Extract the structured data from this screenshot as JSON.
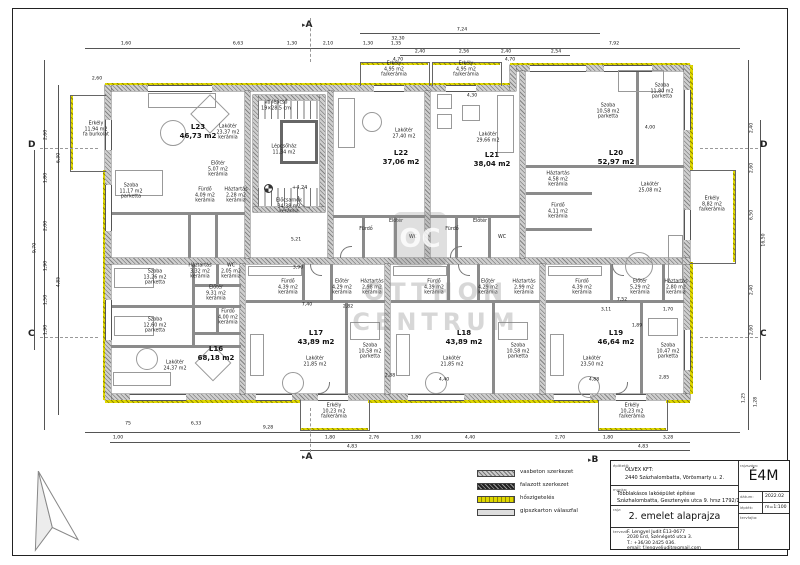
{
  "markers": {
    "a": "A",
    "b": "B",
    "c": "C",
    "d": "D"
  },
  "icons": {
    "section_arrow": "▸"
  },
  "level_mark": "+4,24",
  "watermark": {
    "logo": "OC",
    "line1": "OTTHON",
    "line2": "CENTRUM"
  },
  "legend": {
    "items": [
      {
        "label": "vasbeton szerkezet"
      },
      {
        "label": "falazott szerkezet"
      },
      {
        "label": "hőszigetelés"
      },
      {
        "label": "gipszkarton válaszfal"
      }
    ]
  },
  "apartments": {
    "l23": {
      "id": "L23",
      "area": "46,73 m2"
    },
    "l22": {
      "id": "L22",
      "area": "37,06 m2"
    },
    "l21": {
      "id": "L21",
      "area": "38,04 m2"
    },
    "l20": {
      "id": "L20",
      "area": "52,97 m2"
    },
    "l16": {
      "id": "L16",
      "area": "68,18 m2"
    },
    "l17": {
      "id": "L17",
      "area": "43,89 m2"
    },
    "l18": {
      "id": "L18",
      "area": "43,89 m2"
    },
    "l19": {
      "id": "L19",
      "area": "46,64 m2"
    }
  },
  "room_labels": [
    {
      "x": 96,
      "y": 130,
      "l": [
        "Erkély",
        "11,94 m2",
        "fa burkolat"
      ]
    },
    {
      "x": 228,
      "y": 133,
      "l": [
        "Lakótér",
        "23,37 m2",
        "kerámia"
      ]
    },
    {
      "x": 131,
      "y": 192,
      "l": [
        "Szoba",
        "11,17 m2",
        "parketta"
      ]
    },
    {
      "x": 218,
      "y": 170,
      "l": [
        "Előtér",
        "5,07 m2",
        "kerámia"
      ]
    },
    {
      "x": 205,
      "y": 196,
      "l": [
        "Fürdő",
        "4,09 m2",
        "kerámia"
      ]
    },
    {
      "x": 236,
      "y": 196,
      "l": [
        "Háztartás",
        "2,28 m2",
        "kerámia"
      ]
    },
    {
      "x": 284,
      "y": 150,
      "l": [
        "Lépcsőház",
        "11,34 m2"
      ]
    },
    {
      "x": 276,
      "y": 106,
      "l": [
        "vb lépcső",
        "19×28,5 cm"
      ]
    },
    {
      "x": 289,
      "y": 207,
      "l": [
        "Előcsarnok",
        "34,38 m2",
        "kerámia"
      ]
    },
    {
      "x": 404,
      "y": 134,
      "l": [
        "Lakótér",
        "27,40 m2"
      ]
    },
    {
      "x": 394,
      "y": 70,
      "l": [
        "Erkély",
        "4,95 m2",
        "fa/kerámia"
      ]
    },
    {
      "x": 466,
      "y": 70,
      "l": [
        "Erkély",
        "4,95 m2",
        "fa/kerámia"
      ]
    },
    {
      "x": 366,
      "y": 230,
      "l": [
        "Fürdő"
      ]
    },
    {
      "x": 396,
      "y": 222,
      "l": [
        "Előtér"
      ]
    },
    {
      "x": 413,
      "y": 238,
      "l": [
        "WC"
      ]
    },
    {
      "x": 488,
      "y": 138,
      "l": [
        "Lakótér",
        "29,66 m2"
      ]
    },
    {
      "x": 452,
      "y": 230,
      "l": [
        "Fürdő"
      ]
    },
    {
      "x": 480,
      "y": 222,
      "l": [
        "Előtér"
      ]
    },
    {
      "x": 502,
      "y": 238,
      "l": [
        "WC"
      ]
    },
    {
      "x": 608,
      "y": 112,
      "l": [
        "Szoba",
        "10,58 m2",
        "parketta"
      ]
    },
    {
      "x": 662,
      "y": 92,
      "l": [
        "Szoba",
        "11,80 m2",
        "parketta"
      ]
    },
    {
      "x": 650,
      "y": 188,
      "l": [
        "Lakótér",
        "25,08 m2"
      ]
    },
    {
      "x": 558,
      "y": 180,
      "l": [
        "Háztartás",
        "4,58 m2",
        "kerámia"
      ]
    },
    {
      "x": 558,
      "y": 212,
      "l": [
        "Fürdő",
        "4,11 m2",
        "kerámia"
      ]
    },
    {
      "x": 712,
      "y": 205,
      "l": [
        "Erkély",
        "8,82 m2",
        "fa/kerámia"
      ]
    },
    {
      "x": 155,
      "y": 278,
      "l": [
        "Szoba",
        "13,26 m2",
        "parketta"
      ]
    },
    {
      "x": 155,
      "y": 326,
      "l": [
        "Szoba",
        "12,60 m2",
        "parketta"
      ]
    },
    {
      "x": 216,
      "y": 294,
      "l": [
        "Előtér",
        "9,31 m2",
        "kerámia"
      ]
    },
    {
      "x": 228,
      "y": 318,
      "l": [
        "Fürdő",
        "4,00 m2",
        "kerámia"
      ]
    },
    {
      "x": 231,
      "y": 272,
      "l": [
        "WC",
        "2,05 m2",
        "kerámia"
      ]
    },
    {
      "x": 200,
      "y": 272,
      "l": [
        "Háztartás",
        "3,32 m2",
        "kerámia"
      ]
    },
    {
      "x": 175,
      "y": 366,
      "l": [
        "Lakótér",
        "24,37 m2"
      ]
    },
    {
      "x": 288,
      "y": 288,
      "l": [
        "Fürdő",
        "4,39 m2",
        "kerámia"
      ]
    },
    {
      "x": 342,
      "y": 288,
      "l": [
        "Előtér",
        "4,29 m2",
        "kerámia"
      ]
    },
    {
      "x": 372,
      "y": 288,
      "l": [
        "Háztartás",
        "2,98 m2",
        "kerámia"
      ]
    },
    {
      "x": 315,
      "y": 362,
      "l": [
        "Lakótér",
        "21,85 m2"
      ]
    },
    {
      "x": 370,
      "y": 352,
      "l": [
        "Szoba",
        "10,58 m2",
        "parketta"
      ]
    },
    {
      "x": 334,
      "y": 412,
      "l": [
        "Erkély",
        "10,23 m2",
        "fa/kerámia"
      ]
    },
    {
      "x": 434,
      "y": 288,
      "l": [
        "Fürdő",
        "4,39 m2",
        "kerámia"
      ]
    },
    {
      "x": 488,
      "y": 288,
      "l": [
        "Előtér",
        "4,29 m2",
        "kerámia"
      ]
    },
    {
      "x": 524,
      "y": 288,
      "l": [
        "Háztartás",
        "2,99 m2",
        "kerámia"
      ]
    },
    {
      "x": 452,
      "y": 362,
      "l": [
        "Lakótér",
        "21,85 m2"
      ]
    },
    {
      "x": 518,
      "y": 352,
      "l": [
        "Szoba",
        "10,58 m2",
        "parketta"
      ]
    },
    {
      "x": 582,
      "y": 288,
      "l": [
        "Fürdő",
        "4,39 m2",
        "kerámia"
      ]
    },
    {
      "x": 640,
      "y": 288,
      "l": [
        "Előtér",
        "5,29 m2",
        "kerámia"
      ]
    },
    {
      "x": 676,
      "y": 288,
      "l": [
        "Háztartás",
        "2,80 m2",
        "kerámia"
      ]
    },
    {
      "x": 592,
      "y": 362,
      "l": [
        "Lakótér",
        "23,50 m2"
      ]
    },
    {
      "x": 668,
      "y": 352,
      "l": [
        "Szoba",
        "10,47 m2",
        "parketta"
      ]
    },
    {
      "x": 632,
      "y": 412,
      "l": [
        "Erkély",
        "10,23 m2",
        "fa/kerámia"
      ]
    }
  ],
  "dim_labels": [
    {
      "t": "1,60",
      "x": 126,
      "y": 44
    },
    {
      "t": "6,63",
      "x": 238,
      "y": 44
    },
    {
      "t": "1,30",
      "x": 292,
      "y": 44
    },
    {
      "t": "2,10",
      "x": 328,
      "y": 44
    },
    {
      "t": "1,30",
      "x": 368,
      "y": 44
    },
    {
      "t": "1,35",
      "x": 396,
      "y": 44
    },
    {
      "t": "7,92",
      "x": 614,
      "y": 44
    },
    {
      "t": "2,40",
      "x": 420,
      "y": 52
    },
    {
      "t": "2,56",
      "x": 464,
      "y": 52
    },
    {
      "t": "2,40",
      "x": 506,
      "y": 52
    },
    {
      "t": "2,54",
      "x": 556,
      "y": 52
    },
    {
      "t": "7,24",
      "x": 462,
      "y": 30
    },
    {
      "t": "32,30",
      "x": 398,
      "y": 39
    },
    {
      "t": "4,70",
      "x": 398,
      "y": 60
    },
    {
      "t": "4,70",
      "x": 510,
      "y": 60
    },
    {
      "t": "4,30",
      "x": 472,
      "y": 96
    },
    {
      "t": "4,00",
      "x": 650,
      "y": 128
    },
    {
      "t": "2,60",
      "x": 97,
      "y": 79
    },
    {
      "t": "5,21",
      "x": 296,
      "y": 240
    },
    {
      "t": "3,90",
      "x": 298,
      "y": 268
    },
    {
      "t": "7,40",
      "x": 307,
      "y": 305
    },
    {
      "t": "2,82",
      "x": 348,
      "y": 307
    },
    {
      "t": "7,52",
      "x": 622,
      "y": 300
    },
    {
      "t": "3,11",
      "x": 606,
      "y": 310
    },
    {
      "t": "1,70",
      "x": 668,
      "y": 310
    },
    {
      "t": "1,89",
      "x": 637,
      "y": 326
    },
    {
      "t": "2,88",
      "x": 390,
      "y": 376
    },
    {
      "t": "4,40",
      "x": 444,
      "y": 380
    },
    {
      "t": "4,88",
      "x": 594,
      "y": 380
    },
    {
      "t": "2,85",
      "x": 664,
      "y": 378
    },
    {
      "t": "2,60",
      "x": 46,
      "y": 135,
      "v": 1
    },
    {
      "t": "1,80",
      "x": 46,
      "y": 178,
      "v": 1
    },
    {
      "t": "2,00",
      "x": 46,
      "y": 226,
      "v": 1
    },
    {
      "t": "1,90",
      "x": 46,
      "y": 266,
      "v": 1
    },
    {
      "t": "1,50",
      "x": 46,
      "y": 300,
      "v": 1
    },
    {
      "t": "1,90",
      "x": 46,
      "y": 330,
      "v": 1
    },
    {
      "t": "6,30",
      "x": 59,
      "y": 158,
      "v": 1
    },
    {
      "t": "4,85",
      "x": 59,
      "y": 282,
      "v": 1
    },
    {
      "t": "9,70",
      "x": 35,
      "y": 248,
      "v": 1
    },
    {
      "t": "2,40",
      "x": 752,
      "y": 128,
      "v": 1
    },
    {
      "t": "2,60",
      "x": 752,
      "y": 168,
      "v": 1
    },
    {
      "t": "6,50",
      "x": 752,
      "y": 215,
      "v": 1
    },
    {
      "t": "2,40",
      "x": 752,
      "y": 290,
      "v": 1
    },
    {
      "t": "2,60",
      "x": 752,
      "y": 330,
      "v": 1
    },
    {
      "t": "16,50",
      "x": 764,
      "y": 240,
      "v": 1
    },
    {
      "t": "1,25",
      "x": 744,
      "y": 398,
      "v": 1
    },
    {
      "t": "1,28",
      "x": 756,
      "y": 402,
      "v": 1
    },
    {
      "t": "75",
      "x": 128,
      "y": 424
    },
    {
      "t": "6,33",
      "x": 196,
      "y": 424
    },
    {
      "t": "9,28",
      "x": 268,
      "y": 428
    },
    {
      "t": "1,80",
      "x": 330,
      "y": 438
    },
    {
      "t": "2,76",
      "x": 374,
      "y": 438
    },
    {
      "t": "1,80",
      "x": 416,
      "y": 438
    },
    {
      "t": "4,40",
      "x": 470,
      "y": 438
    },
    {
      "t": "2,70",
      "x": 560,
      "y": 438
    },
    {
      "t": "1,80",
      "x": 608,
      "y": 438
    },
    {
      "t": "3,28",
      "x": 668,
      "y": 438
    },
    {
      "t": "4,83",
      "x": 352,
      "y": 447
    },
    {
      "t": "4,83",
      "x": 643,
      "y": 447
    },
    {
      "t": "1,00",
      "x": 118,
      "y": 438
    }
  ],
  "title_block": {
    "client_label": "építtető:",
    "client1": "OLVEX KFT:",
    "client2": "2440 Százhalombatta, Vörösmarty u. 2.",
    "work_label": "munka:",
    "work1": "Többlakásos lakóépület építése",
    "work2": "Százhalombatta, Gesztenyés utca 9.   hrsz 1792/1",
    "drawing_label": "rajz:",
    "drawing_title": "2. emelet alaprajza",
    "designer_label": "tervező:",
    "designer1": "F. Lengyel Judit É13-0677",
    "designer2": "2030 Érd, Szénégető utca 3.",
    "designer3": "T.: +36/30 2425 036.",
    "designer4": "email: f.lengyeljudit@gmail.com",
    "code_label": "rajzszám:",
    "code": "É4M",
    "date_label": "dátum:",
    "date": "2022.02",
    "scale_label": "lépték:",
    "scale": "m=1:100",
    "kind_label": "tervfajta:"
  }
}
